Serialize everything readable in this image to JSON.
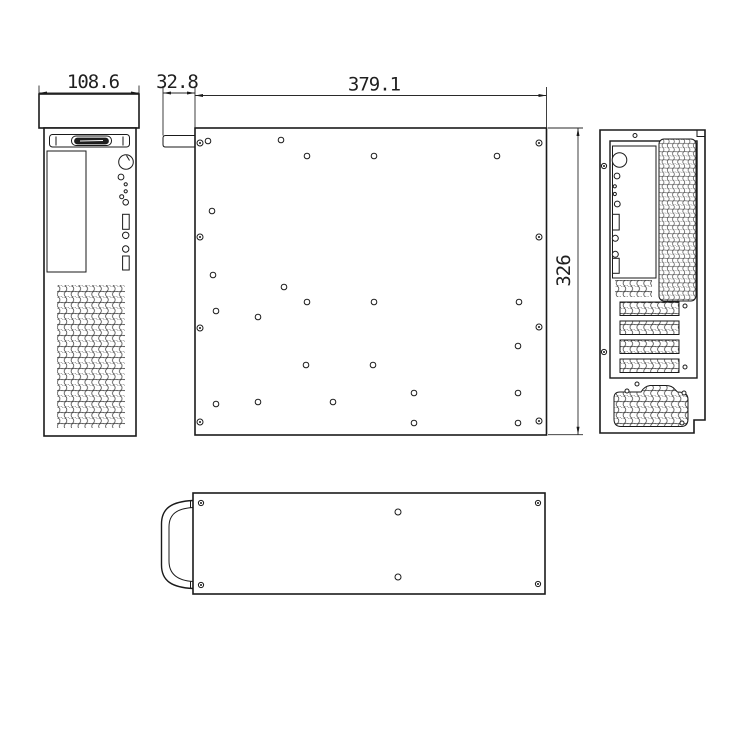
{
  "dimensions": {
    "front_width": "108.6",
    "front_depth_tab": "32.8",
    "body_length": "379.1",
    "body_height": "326"
  },
  "side_view": {
    "panel_screws": [
      [
        200,
        143
      ],
      [
        200,
        237
      ],
      [
        200,
        328
      ],
      [
        200,
        422
      ],
      [
        539,
        143
      ],
      [
        539,
        237
      ],
      [
        539,
        327
      ],
      [
        539,
        421
      ]
    ],
    "mount_holes": [
      [
        208,
        141
      ],
      [
        281,
        140
      ],
      [
        307,
        156
      ],
      [
        374,
        156
      ],
      [
        497,
        156
      ],
      [
        212,
        211
      ],
      [
        213,
        275
      ],
      [
        284,
        287
      ],
      [
        307,
        302
      ],
      [
        374,
        302
      ],
      [
        519,
        302
      ],
      [
        216,
        311
      ],
      [
        258,
        317
      ],
      [
        518,
        346
      ],
      [
        306,
        365
      ],
      [
        373,
        365
      ],
      [
        216,
        404
      ],
      [
        258,
        402
      ],
      [
        333,
        402
      ],
      [
        414,
        393
      ],
      [
        518,
        393
      ],
      [
        414,
        423
      ],
      [
        518,
        423
      ]
    ]
  },
  "bottom_view": {
    "corner_screws": [
      [
        201,
        503
      ],
      [
        538,
        503
      ],
      [
        201,
        585
      ],
      [
        538,
        584
      ]
    ],
    "mount_holes": [
      [
        398,
        512
      ],
      [
        398,
        577
      ]
    ]
  },
  "rear_view": {
    "frame_screws": [
      [
        604,
        166
      ],
      [
        604,
        352
      ]
    ],
    "small_holes": [
      [
        635,
        135.5
      ],
      [
        685,
        306
      ],
      [
        685,
        367
      ],
      [
        637,
        384
      ],
      [
        627,
        391
      ],
      [
        684,
        393
      ],
      [
        682,
        423
      ]
    ]
  }
}
